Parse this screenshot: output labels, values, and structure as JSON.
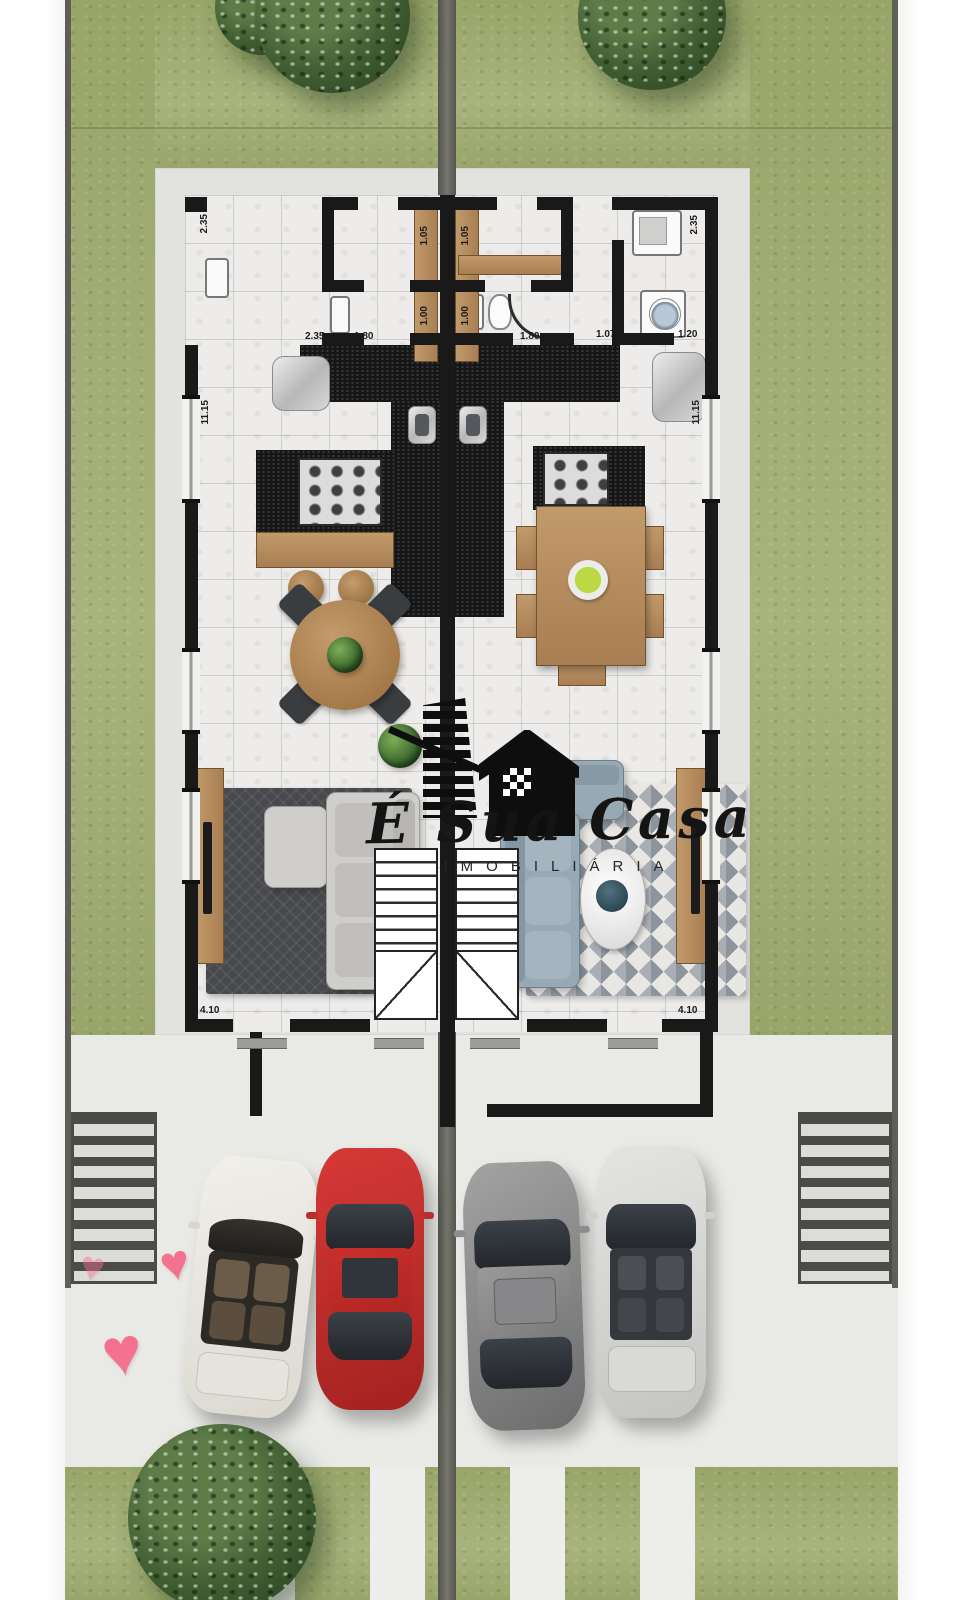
{
  "document": {
    "kind": "architectural floor plan rendering, mirrored duplex ground floor with driveway and cars"
  },
  "watermark": {
    "script": "É Sua Casa",
    "subtitle": "IMOBILIÁRIA"
  },
  "dims": [
    {
      "text": "2.35"
    },
    {
      "text": "1.05"
    },
    {
      "text": "1.05"
    },
    {
      "text": "1.00"
    },
    {
      "text": "1.00"
    },
    {
      "text": "2.35"
    },
    {
      "text": "1.80"
    },
    {
      "text": "1.80"
    },
    {
      "text": "1.07"
    },
    {
      "text": "1.20"
    },
    {
      "text": "2.35"
    },
    {
      "text": "11.15"
    },
    {
      "text": "11.15"
    },
    {
      "text": "4.10"
    },
    {
      "text": "4.10"
    }
  ],
  "icons": {
    "heart": "♥"
  },
  "colors": {
    "grass": "#a3af74",
    "pavement": "#e9e9e6",
    "wall_black": "#191919",
    "divider_gray": "#6b6b64",
    "wood": "#b28a5e",
    "rug_dark": "#47494c",
    "sofa_blue": "#97a9b4",
    "heart_pink": "#f4718f",
    "car_white": "#ece9e2",
    "car_red": "#c33030",
    "car_gray": "#8a8a8a",
    "car_silver": "#dcdcda"
  }
}
